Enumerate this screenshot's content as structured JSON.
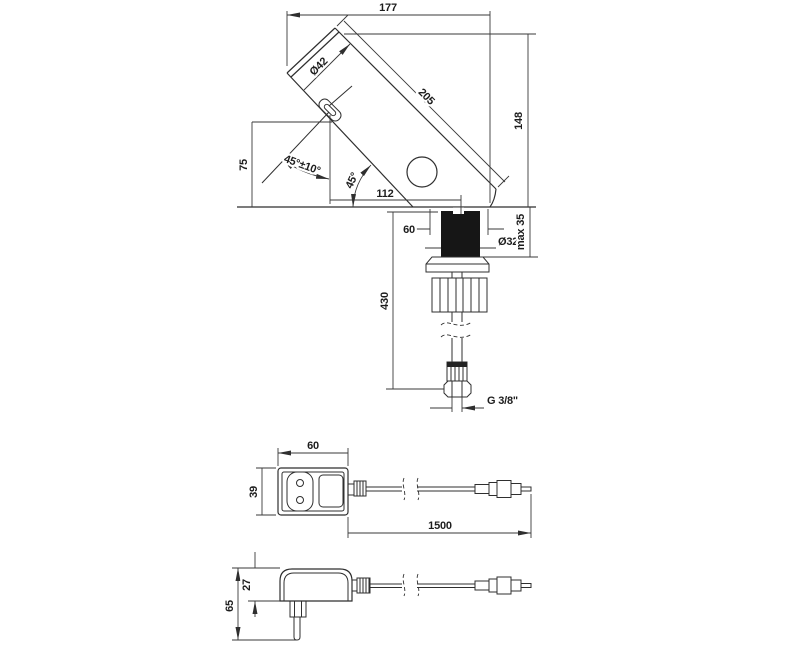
{
  "colors": {
    "line": "#2f2f2f",
    "shank_fill": "#161616",
    "background": "#ffffff"
  },
  "faucet": {
    "dims": {
      "overall_width": "177",
      "spout_diameter": "Ø42",
      "body_length": "205",
      "overall_height": "148",
      "outlet_height": "75",
      "sensor_angle": "45°±10°",
      "body_angle": "45°",
      "outlet_offset": "112",
      "base_width": "60",
      "shank_diameter": "Ø32",
      "max_deck_thickness": "max 35",
      "hose_length": "430",
      "thread": "G 3/8\""
    }
  },
  "adapter_top": {
    "dims": {
      "width": "60",
      "depth": "39",
      "cable_length": "1500"
    }
  },
  "adapter_side": {
    "dims": {
      "body_height": "27",
      "total_height": "65"
    }
  }
}
